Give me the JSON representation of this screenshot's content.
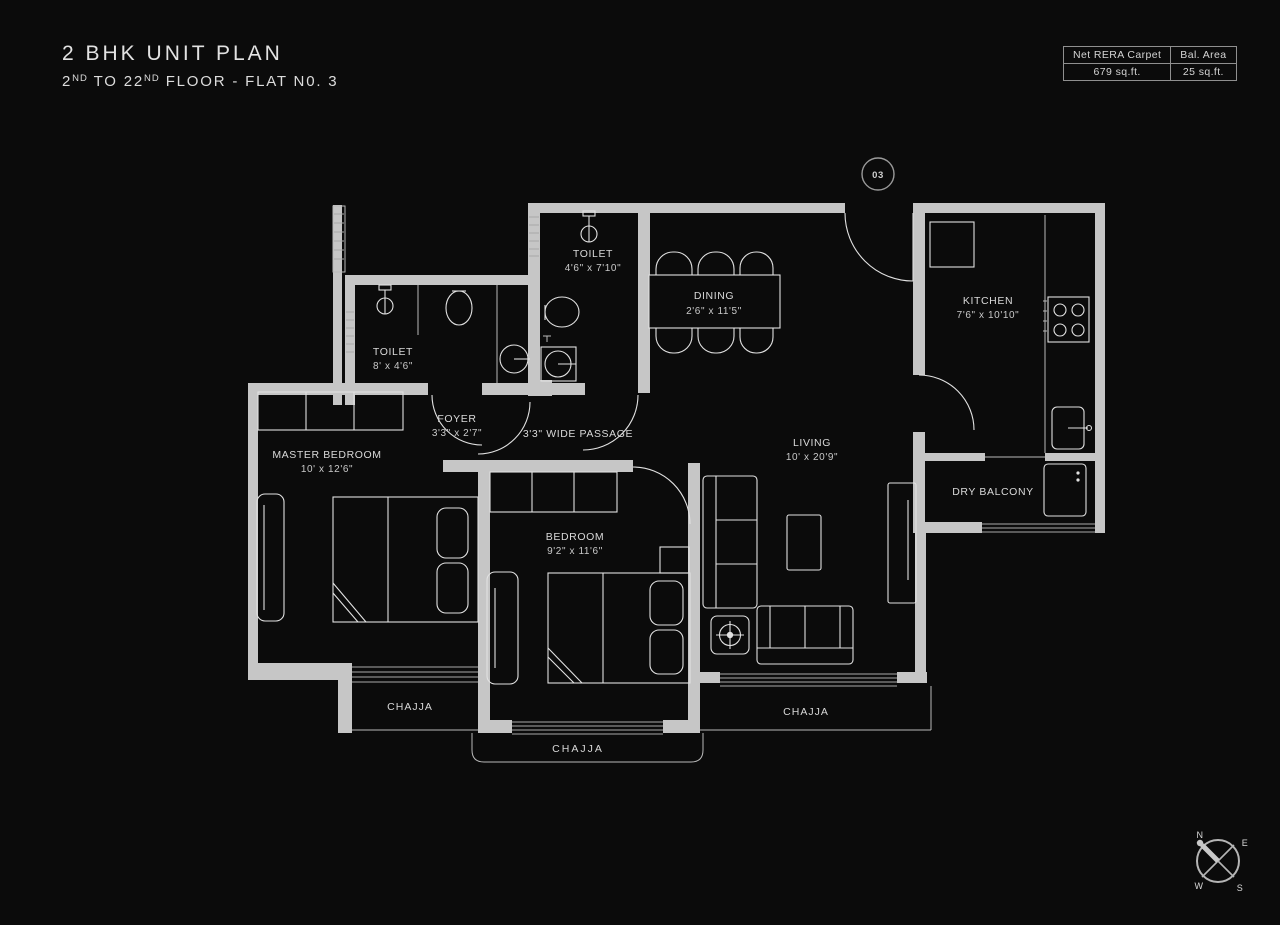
{
  "header": {
    "title": "2 BHK UNIT PLAN",
    "subtitle": {
      "p1": "2",
      "sup1": "ND",
      "p2": " TO 22",
      "sup2": "ND",
      "p3": " FLOOR - FLAT N0. 3"
    }
  },
  "area_table": {
    "col1_header": "Net RERA Carpet",
    "col2_header": "Bal. Area",
    "col1_value": "679 sq.ft.",
    "col2_value": "25 sq.ft."
  },
  "unit_marker": "03",
  "rooms": {
    "toilet_top": {
      "name": "TOILET",
      "dims": "4'6\" x 7'10\""
    },
    "toilet_left": {
      "name": "TOILET",
      "dims": "8' x 4'6\""
    },
    "dining": {
      "name": "DINING",
      "dims": "2'6\" x 11'5\""
    },
    "kitchen": {
      "name": "KITCHEN",
      "dims": "7'6\" x 10'10\""
    },
    "foyer": {
      "name": "FOYER",
      "dims": "3'3\" x 2'7\""
    },
    "passage": {
      "name": "3'3\" WIDE PASSAGE"
    },
    "master_bedroom": {
      "name": "MASTER BEDROOM",
      "dims": "10' x 12'6\""
    },
    "bedroom": {
      "name": "BEDROOM",
      "dims": "9'2\" x 11'6\""
    },
    "living": {
      "name": "LIVING",
      "dims": "10' x 20'9\""
    },
    "dry_balcony": {
      "name": "DRY BALCONY"
    },
    "chajja_left": {
      "name": "CHAJJA"
    },
    "chajja_bottom": {
      "name": "CHAJJA"
    },
    "chajja_right": {
      "name": "CHAJJA"
    }
  },
  "compass": {
    "n": "N",
    "e": "E",
    "w": "W",
    "s": "S"
  },
  "colors": {
    "background": "#0b0b0b",
    "wall": "#c6c6c6",
    "line": "#e2e2e2",
    "text": "#d9d9d9"
  }
}
